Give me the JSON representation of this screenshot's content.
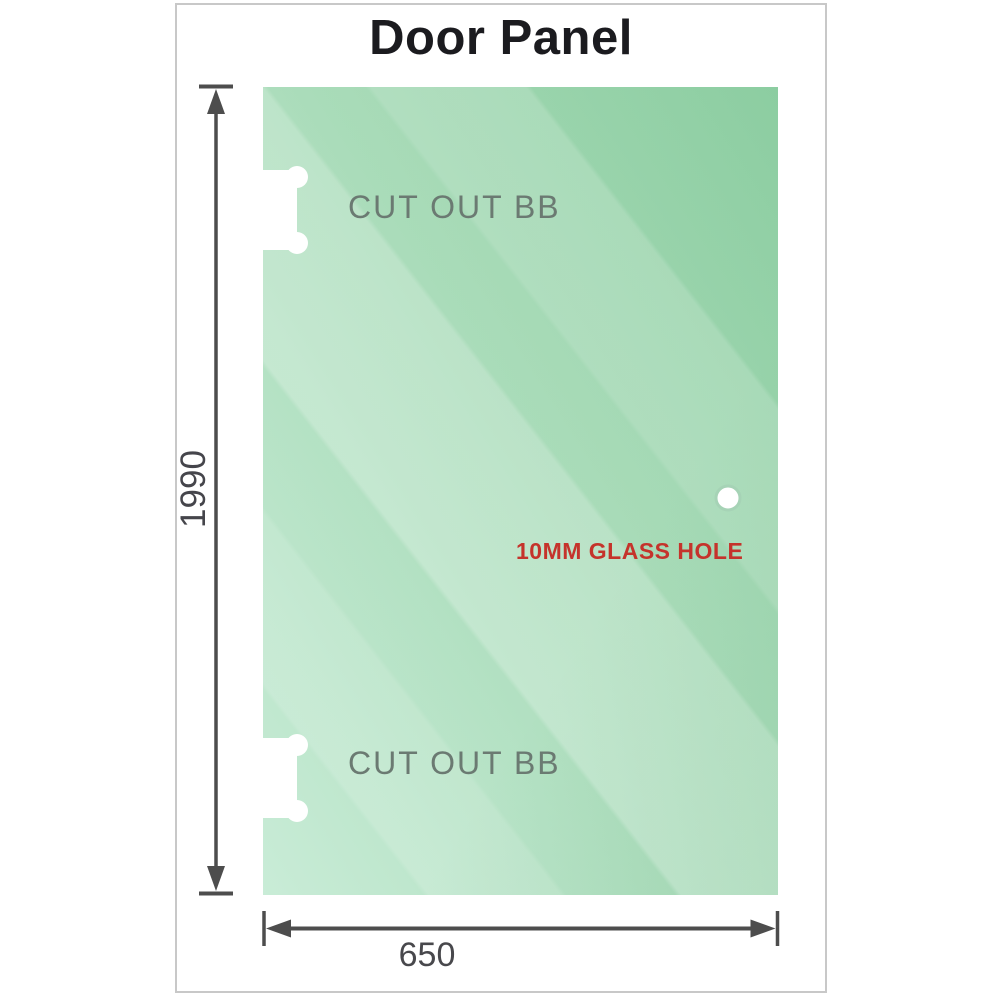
{
  "title": "Door Panel",
  "diagram": {
    "cutouts": [
      {
        "label": "CUT OUT BB"
      },
      {
        "label": "CUT OUT BB"
      }
    ],
    "glass_hole": {
      "label": "10MM GLASS HOLE"
    },
    "dimensions": {
      "height": "1990",
      "width": "650"
    }
  },
  "colors": {
    "glass_dark": "#8acc9f",
    "glass_light": "#c9ecd7",
    "dimension_line": "#4d4d4d",
    "cutout_label": "#6b7a72",
    "glass_hole_label": "#c5332b",
    "title": "#1b1b1f",
    "frame_border": "#c8c8c8"
  }
}
